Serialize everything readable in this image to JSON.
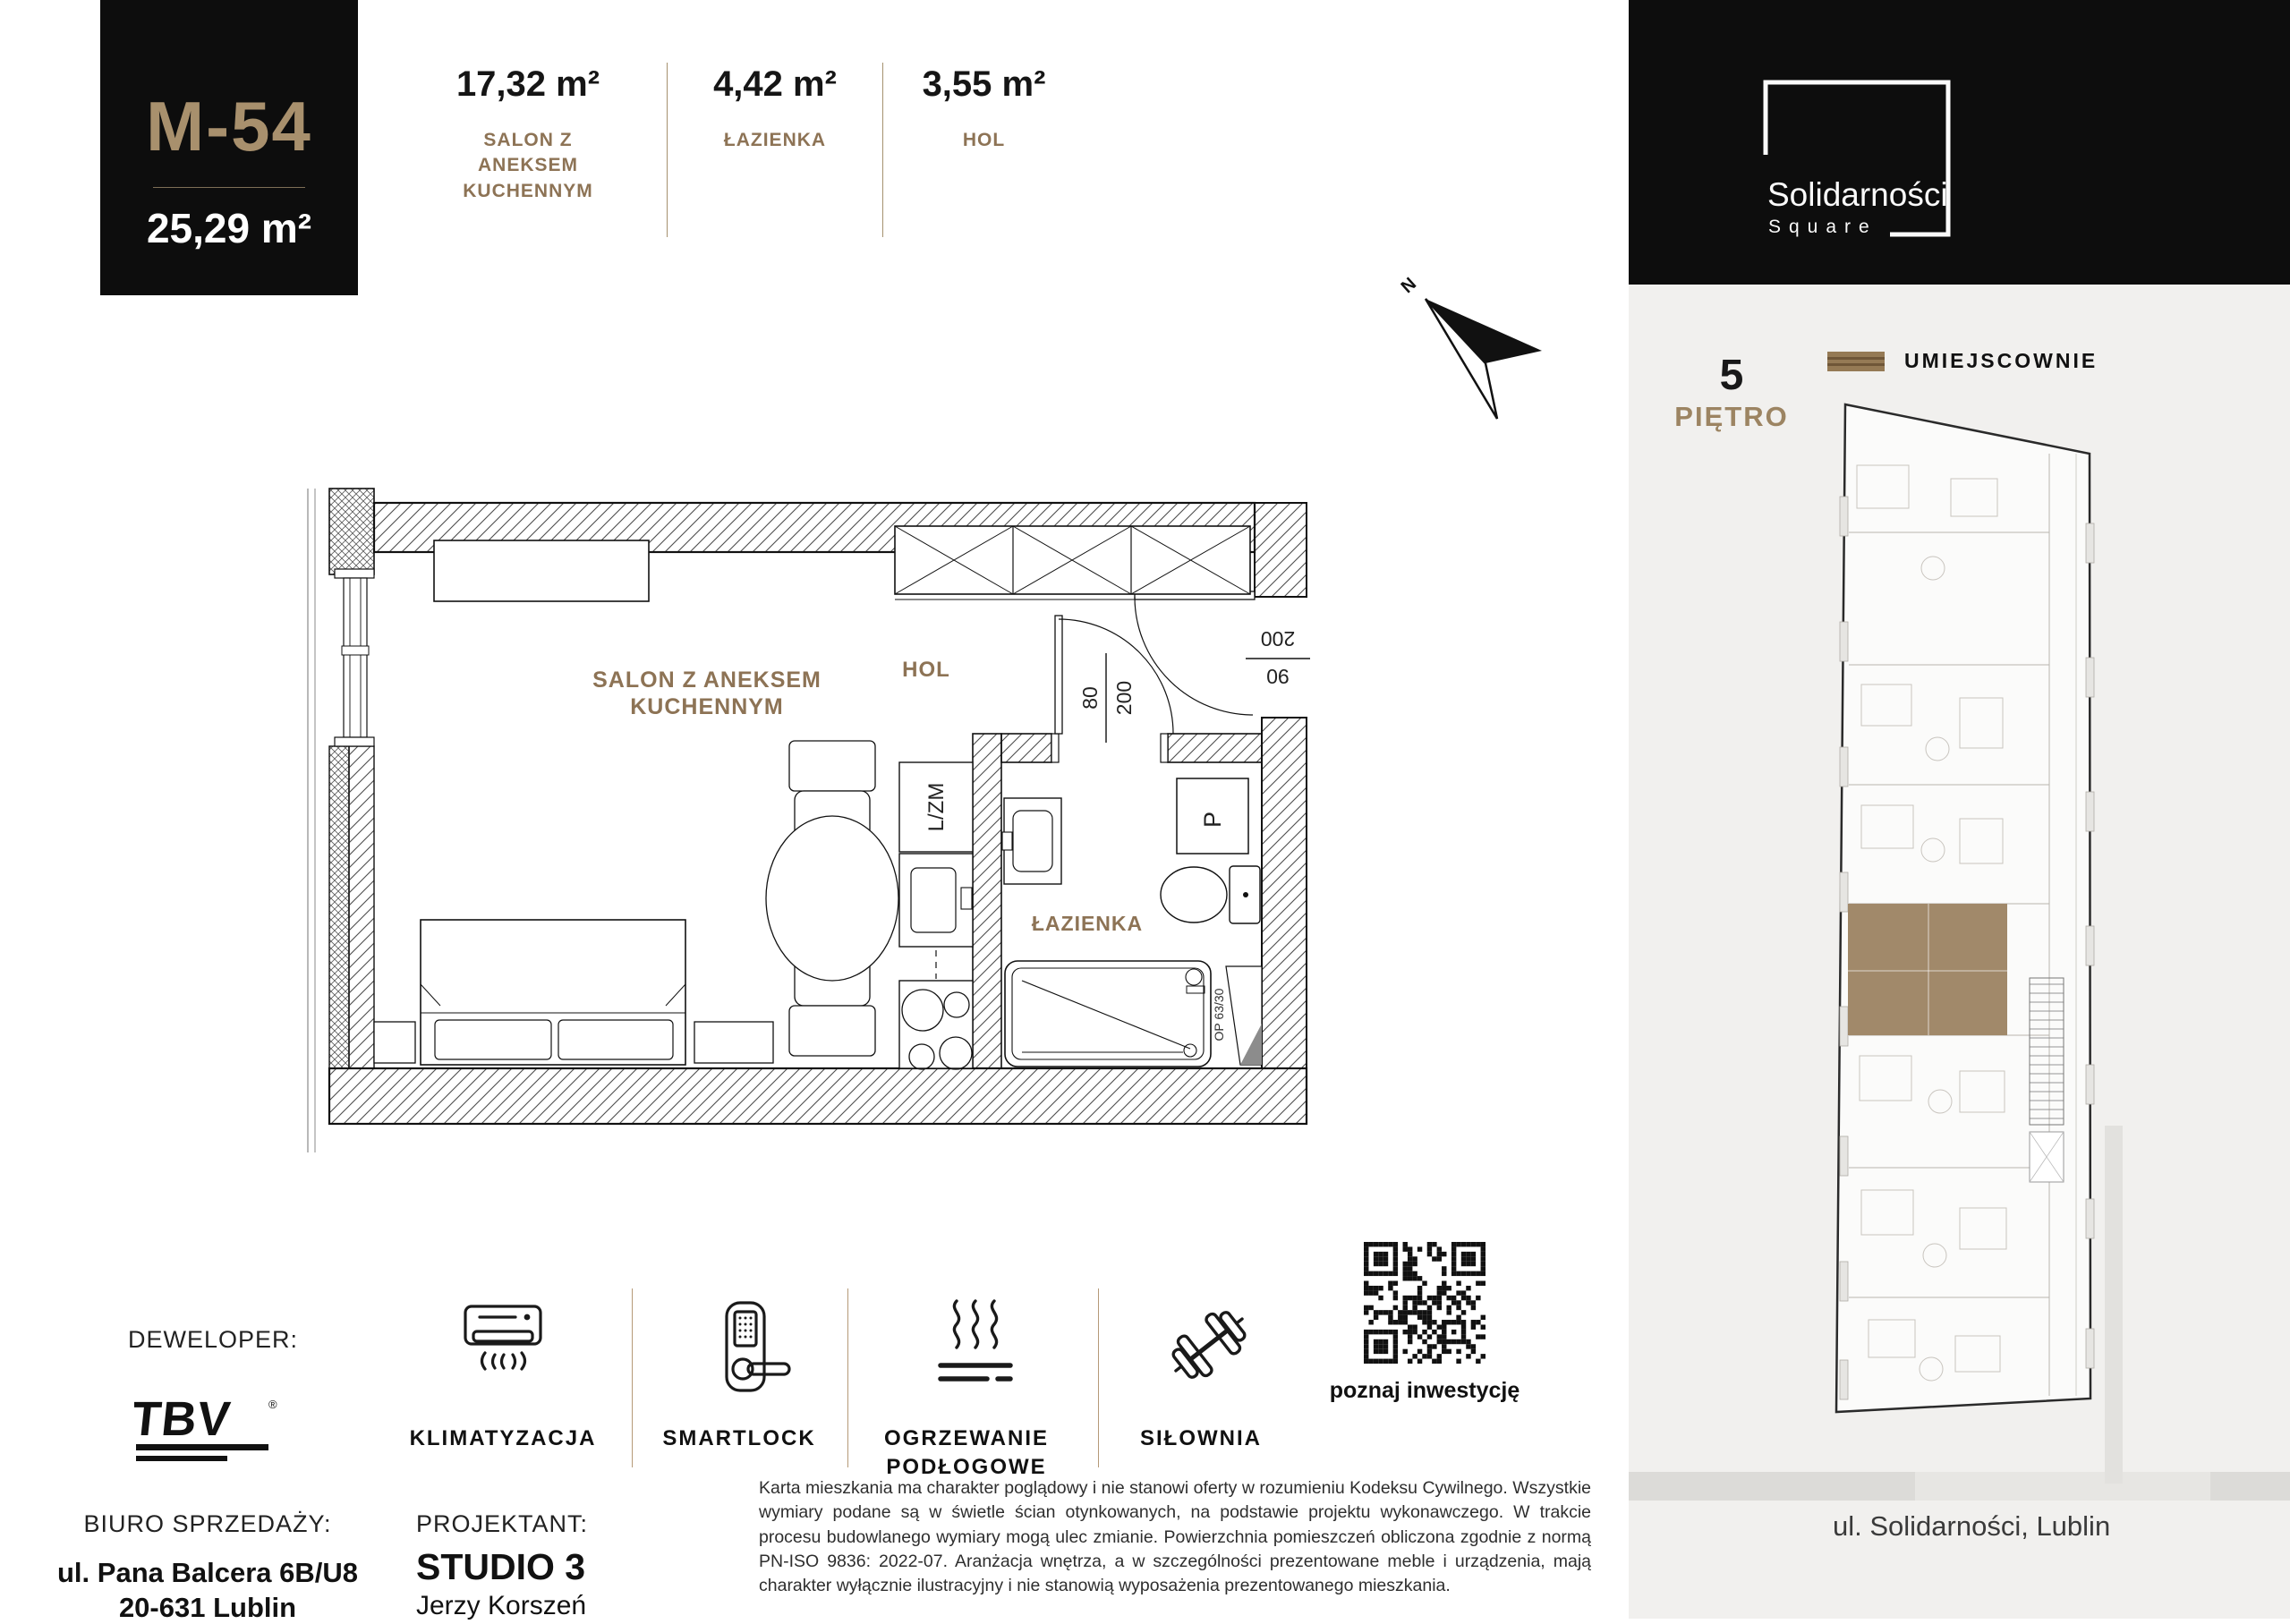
{
  "header": {
    "unit_id": "M-54",
    "total_area": "25,29 m²",
    "rooms": [
      {
        "area": "17,32 m²",
        "name": "SALON Z ANEKSEM KUCHENNYM"
      },
      {
        "area": "4,42 m²",
        "name": "ŁAZIENKA"
      },
      {
        "area": "3,55 m²",
        "name": "HOL"
      }
    ]
  },
  "plan": {
    "salon_line1": "SALON Z ANEKSEM",
    "salon_line2": "KUCHENNYM",
    "hol": "HOL",
    "bathroom": "ŁAZIENKA",
    "kitchen_unit": "L/ZM",
    "washer": "P",
    "window_code": "OP 63/30",
    "entry_door_height": "200",
    "entry_door_width": "90",
    "bath_door_width": "80",
    "bath_door_height": "200",
    "compass": "N"
  },
  "brand": {
    "line1": "Solidarności",
    "line2": "Square"
  },
  "floor": {
    "number": "5",
    "label": "PIĘTRO"
  },
  "location": {
    "header": "UMIEJSCOWNIE",
    "address": "ul. Solidarności, Lublin"
  },
  "developer": {
    "label": "DEWELOPER:",
    "logo_text": "TBV"
  },
  "amenities": [
    {
      "label": "KLIMATYZACJA"
    },
    {
      "label": "SMARTLOCK"
    },
    {
      "label": "OGRZEWANIE PODŁOGOWE"
    },
    {
      "label": "SIŁOWNIA"
    }
  ],
  "qr": {
    "caption": "poznaj inwestycję"
  },
  "sales_office": {
    "label": "BIURO SPRZEDAŻY:",
    "address_line1": "ul. Pana Balcera 6B/U8",
    "address_line2": "20-631 Lublin"
  },
  "designer": {
    "label": "PROJEKTANT:",
    "studio": "STUDIO 3",
    "name": "Jerzy Korszeń"
  },
  "disclaimer": "Karta mieszkania ma charakter poglądowy i nie stanowi oferty w rozumieniu Kodeksu Cywilnego. Wszystkie wymiary podane są w świetle ścian otynkowanych, na podstawie projektu wykonawczego. W trakcie procesu budowlanego wymiary mogą ulec zmianie. Powierzchnia pomieszczeń obliczona zgodnie z normą PN-ISO 9836: 2022-07. Aranżacja wnętrza, a w szczególności prezentowane meble i urządzenia, mają charakter wyłącznie ilustracyjny i nie stanowią wyposażenia prezentowanego mieszkania.",
  "colors": {
    "accent_tan": "#8d7355",
    "gold": "#a8906d",
    "panel_bg": "#f1f0ee",
    "black": "#0d0d0d"
  }
}
